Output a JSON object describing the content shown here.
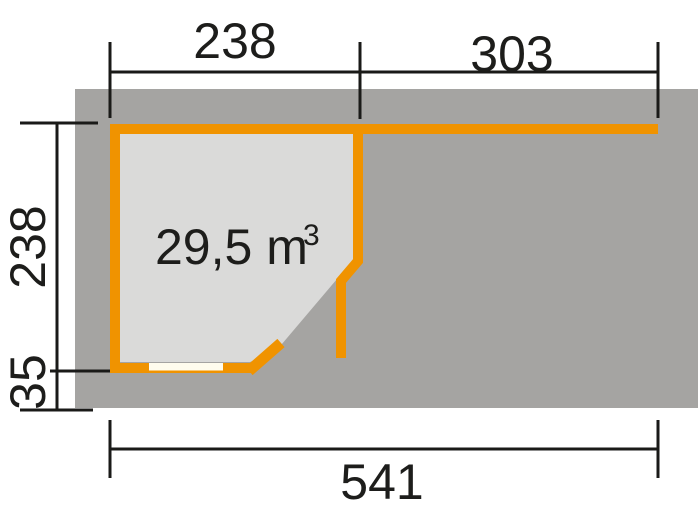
{
  "floor_plan": {
    "title": "garden-house floor plan with side canopy",
    "volume_label": {
      "value": "29,5 m",
      "superscript": "3"
    },
    "dimensions": {
      "shed_width": "238",
      "canopy_width": "303",
      "shed_depth": "238",
      "roof_overhang": "35",
      "total_width": "541"
    },
    "colors": {
      "wall_orange": "#F09300",
      "base_gray": "#A5A4A2",
      "interior_gray": "#DADAD9",
      "window_white": "#FFFCEE",
      "dimension_black": "#1A1A18"
    }
  }
}
